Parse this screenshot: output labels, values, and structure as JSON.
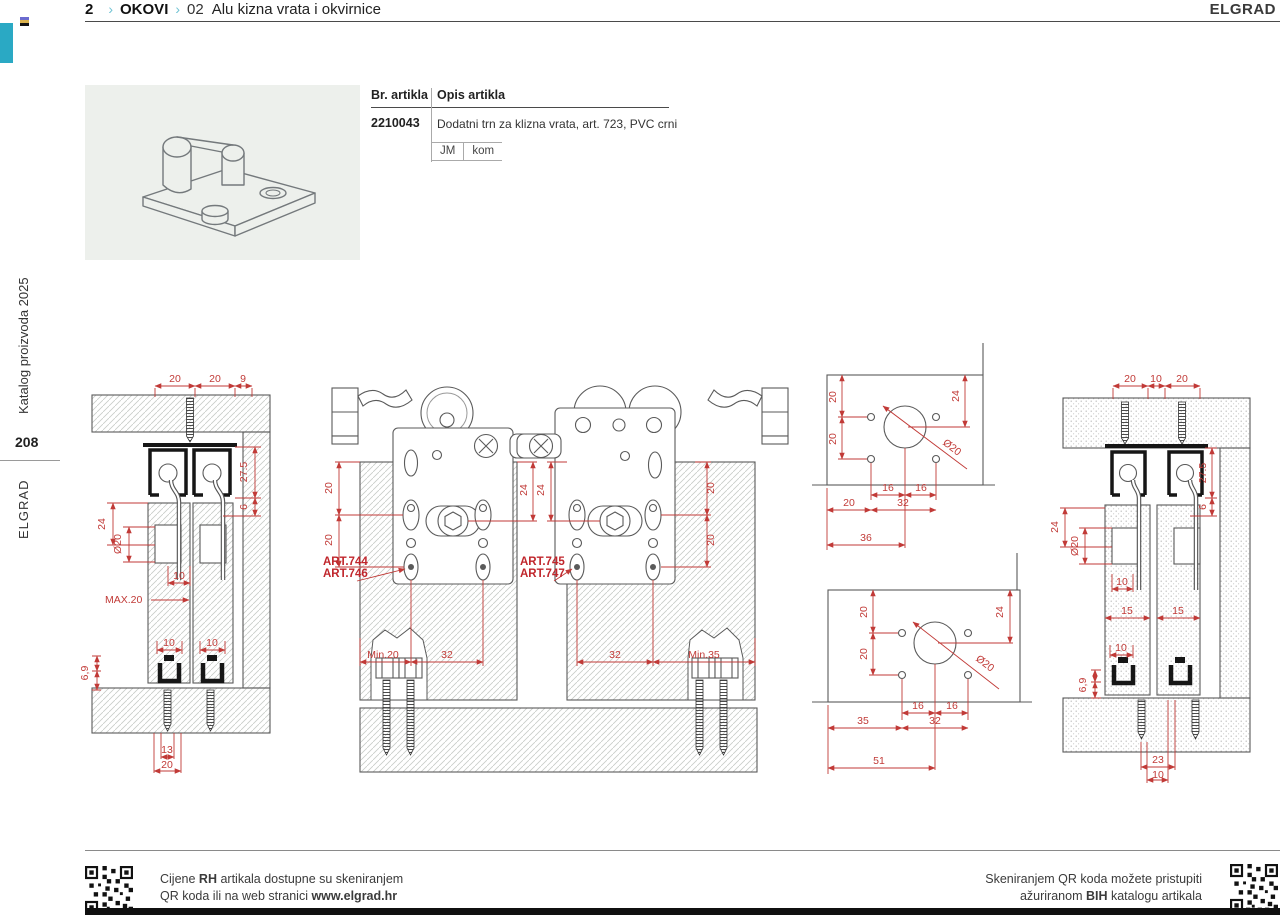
{
  "header": {
    "page_ref": "2",
    "sep1": "›",
    "section": "OKOVI",
    "sep2": "›",
    "code": "02",
    "title": "Alu kizna vrata i okvirnice",
    "brand": "ELGRAD"
  },
  "sidebar": {
    "catalog": "Katalog proizvoda 2025",
    "page_number": "208",
    "brand": "ELGRAD"
  },
  "product": {
    "columns": {
      "article": "Br. artikla",
      "description": "Opis artikla"
    },
    "article_number": "2210043",
    "description": "Dodatni trn za klizna vrata, art. 723, PVC crni",
    "unit_label": "JM",
    "unit_value": "kom"
  },
  "drawings": {
    "accent_color": "#c13a37",
    "a": {
      "dims": [
        "20",
        "20",
        "9",
        "27.5",
        "6",
        "24",
        "Ø20",
        "10",
        "MAX.20",
        "10",
        "10",
        "6,9",
        "13",
        "20"
      ]
    },
    "b": {
      "dims": [
        "20",
        "20",
        "24",
        "ART.744",
        "ART.746",
        "Min.20",
        "32",
        "24",
        "20",
        "20",
        "ART.745",
        "ART.747",
        "32",
        "Min.35"
      ]
    },
    "c1": {
      "dims": [
        "20",
        "20",
        "24",
        "Ø20",
        "16",
        "16",
        "20",
        "32",
        "36"
      ]
    },
    "c2": {
      "dims": [
        "20",
        "20",
        "24",
        "Ø20",
        "16",
        "16",
        "35",
        "32",
        "51"
      ]
    },
    "d": {
      "dims": [
        "20",
        "10",
        "20",
        "27.5",
        "6",
        "24",
        "Ø20",
        "10",
        "15",
        "15",
        "10",
        "6,9",
        "23",
        "10"
      ]
    }
  },
  "footer": {
    "left_line1": [
      "Cijene ",
      "RH",
      " artikala dostupne su skeniranjem"
    ],
    "left_line2": [
      "QR koda ili na web stranici ",
      "www.elgrad.hr"
    ],
    "right_line1": "Skeniranjem QR koda možete pristupiti",
    "right_line2": [
      "ažuriranom ",
      "BIH",
      " katalogu artikala"
    ]
  }
}
